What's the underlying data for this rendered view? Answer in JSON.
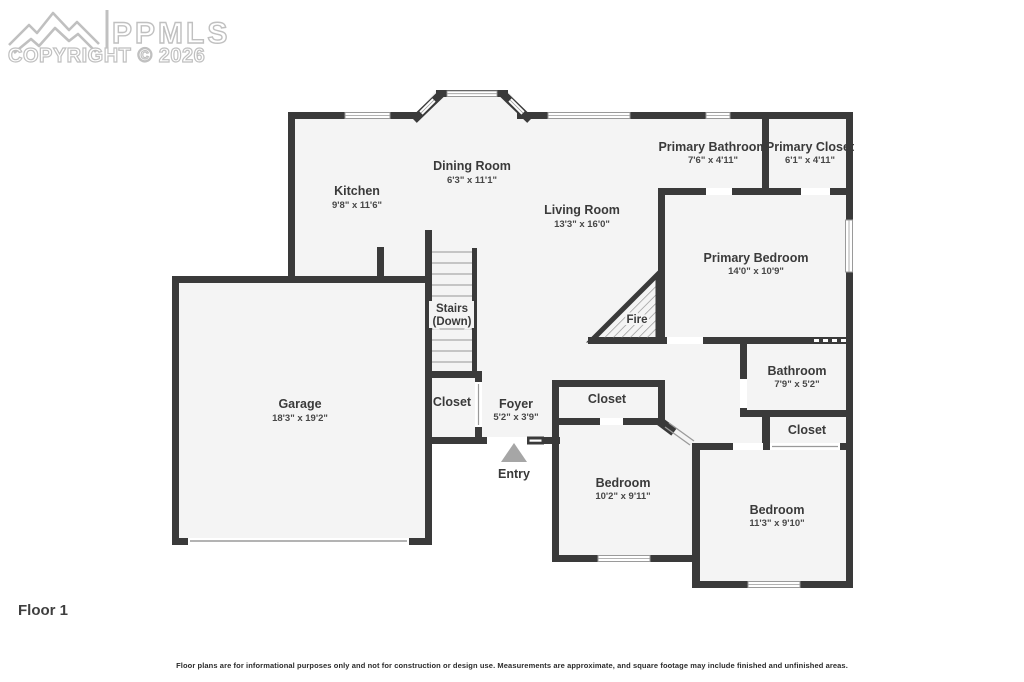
{
  "watermark": {
    "brand": "PPMLS",
    "copyright": "COPYRIGHT © 2026"
  },
  "floor_label": "Floor 1",
  "disclaimer": "Floor plans are for informational purposes only and not for construction or design use. Measurements are approximate, and square footage may include finished and unfinished areas.",
  "rooms": {
    "dining": {
      "name": "Dining Room",
      "dims": "6'3\" x 11'1\""
    },
    "kitchen": {
      "name": "Kitchen",
      "dims": "9'8\" x 11'6\""
    },
    "living": {
      "name": "Living Room",
      "dims": "13'3\" x 16'0\""
    },
    "primary_bathroom": {
      "name": "Primary Bathroom",
      "dims": "7'6\" x 4'11\""
    },
    "primary_closet": {
      "name": "Primary Closet",
      "dims": "6'1\" x 4'11\""
    },
    "primary_bedroom": {
      "name": "Primary Bedroom",
      "dims": "14'0\" x 10'9\""
    },
    "stairs": {
      "line1": "Stairs",
      "line2": "(Down)"
    },
    "fireplace": {
      "name": "Fire"
    },
    "garage": {
      "name": "Garage",
      "dims": "18'3\" x 19'2\""
    },
    "garage_closet": {
      "name": "Closet"
    },
    "foyer": {
      "name": "Foyer",
      "dims": "5'2\" x 3'9\""
    },
    "entry": {
      "name": "Entry"
    },
    "bedroom1_closet": {
      "name": "Closet"
    },
    "bathroom": {
      "name": "Bathroom",
      "dims": "7'9\" x 5'2\""
    },
    "hall_closet": {
      "name": "Closet"
    },
    "bedroom1": {
      "name": "Bedroom",
      "dims": "10'2\" x 9'11\""
    },
    "bedroom2": {
      "name": "Bedroom",
      "dims": "11'3\" x 9'10\""
    }
  },
  "colors": {
    "wall": "#3a3a3a",
    "room_fill": "#f4f4f4",
    "label": "#3a3a3a",
    "watermark": "#c0c0c0",
    "entry_arrow": "#a6a6a6"
  }
}
